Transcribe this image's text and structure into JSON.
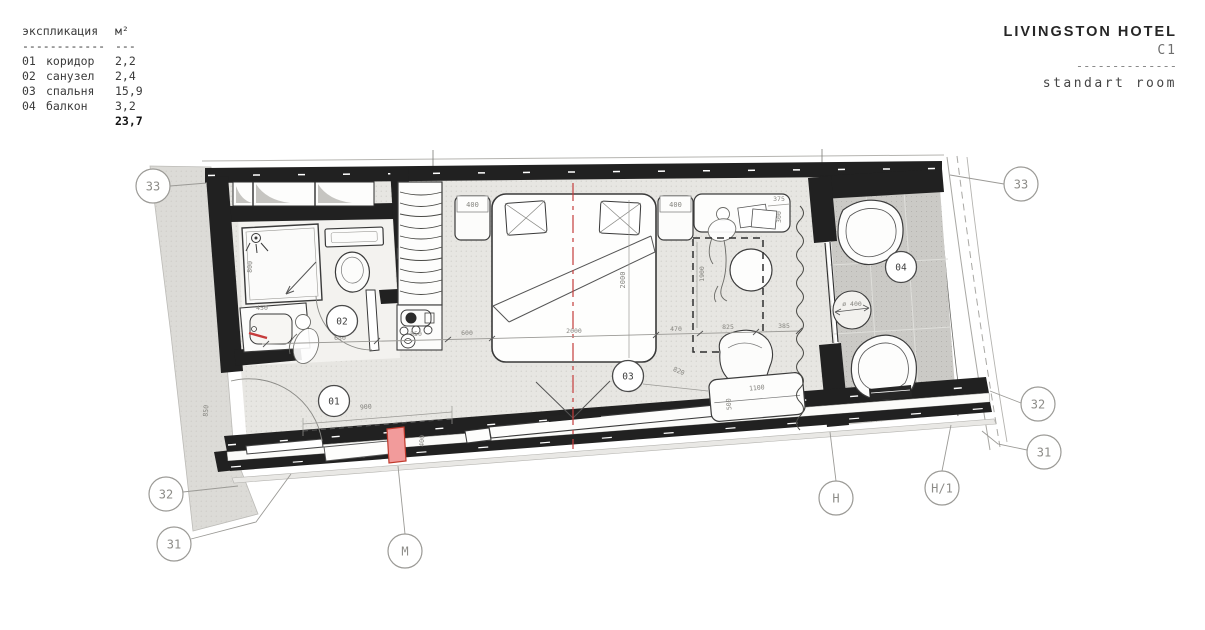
{
  "legend": {
    "title": "экспликация",
    "unit": "м²",
    "dash_main": "------------",
    "dash_unit": "---",
    "rows": [
      {
        "num": "01",
        "name": "коридор",
        "area": "2,2"
      },
      {
        "num": "02",
        "name": "санузел",
        "area": "2,4"
      },
      {
        "num": "03",
        "name": "спальня",
        "area": "15,9"
      },
      {
        "num": "04",
        "name": "балкон",
        "area": "3,2"
      }
    ],
    "total": "23,7"
  },
  "title_block": {
    "hotel": "LIVINGSTON HOTEL",
    "unit_code": "C1",
    "divider": "--------------",
    "room_type": "standart room"
  },
  "plan": {
    "rooms": {
      "corridor": "01",
      "bathroom": "02",
      "bedroom": "03",
      "balcony": "04"
    },
    "axes": {
      "left_33": "33",
      "right_33": "33",
      "left_32": "32",
      "left_31": "31",
      "right_32": "32",
      "right_31": "31",
      "m": "M",
      "h": "H",
      "h1": "H/1"
    },
    "dims": {
      "nightstand_left": "400",
      "nightstand_right": "400",
      "bed_width": "2000",
      "chain_bath": "650",
      "chain_closet": "550",
      "chain_entry": "600",
      "chain_bed": "2000",
      "chain_gap": "470",
      "chain_desk": "825",
      "chain_curtain": "385",
      "desk_width": "375",
      "desk_depth": "300",
      "desk_zone": "1900",
      "diag": "820",
      "table_length": "1100",
      "table_depth": "500",
      "wardrobe": "900",
      "minibar": "400",
      "entry": "850",
      "shower": "800",
      "vanity": "450",
      "balcony_table": "ø 400"
    },
    "colors": {
      "wall": "#212121",
      "accent": "#c23b3b",
      "minibar": "#f29b9b",
      "floor": "#e7e6e2",
      "balcony_slab": "#cbcac6"
    }
  }
}
